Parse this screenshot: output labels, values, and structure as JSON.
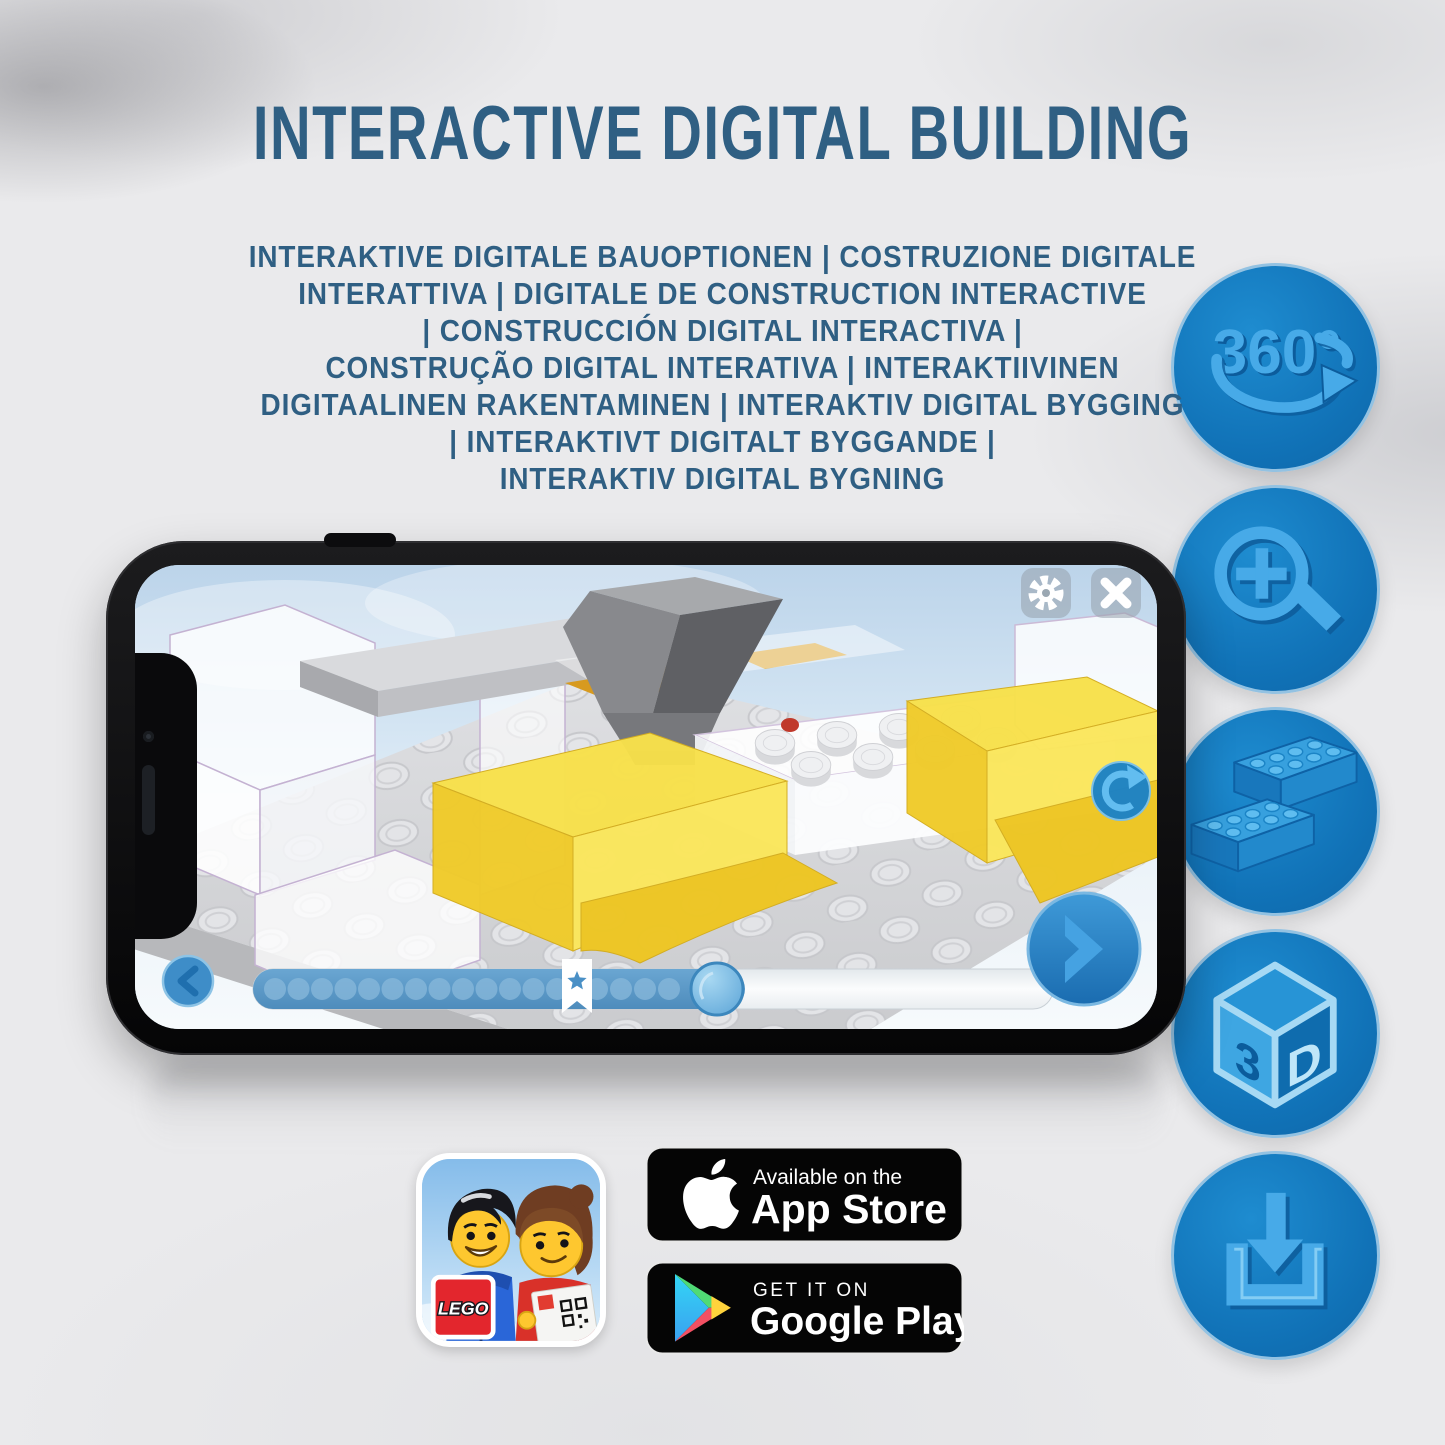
{
  "page": {
    "title": "INTERACTIVE DIGITAL BUILDING",
    "subtitle_lines": [
      "INTERAKTIVE DIGITALE BAUOPTIONEN | COSTRUZIONE DIGITALE",
      "INTERATTIVA | DIGITALE DE CONSTRUCTION INTERACTIVE",
      "| CONSTRUCCIÓN DIGITAL INTERACTIVA |",
      "CONSTRUÇÃO DIGITAL INTERATIVA | INTERAKTIIVINEN",
      "DIGITAALINEN RAKENTAMINEN | INTERAKTIV DIGITAL BYGGING",
      "| INTERAKTIVT DIGITALT BYGGANDE |",
      "INTERAKTIV DIGITAL BYGNING"
    ]
  },
  "feature_badges": {
    "rotation_label": "360°",
    "cube_left": "3",
    "cube_right": "D"
  },
  "store_badges": {
    "lego_logo": "LEGO",
    "app_store_tagline": "Available on the",
    "app_store_name": "App Store",
    "google_play_tagline": "GET IT ON",
    "google_play_name": "Google Play"
  },
  "colors": {
    "title_blue": "#2f5f83",
    "feature_circle_blue": "#1173b8",
    "icon_light_blue": "#47aae8",
    "brick_yellow": "#f8e14b",
    "progress_fill_blue": "#5e9bc8",
    "phone_frame_black": "#0a0a0c"
  }
}
